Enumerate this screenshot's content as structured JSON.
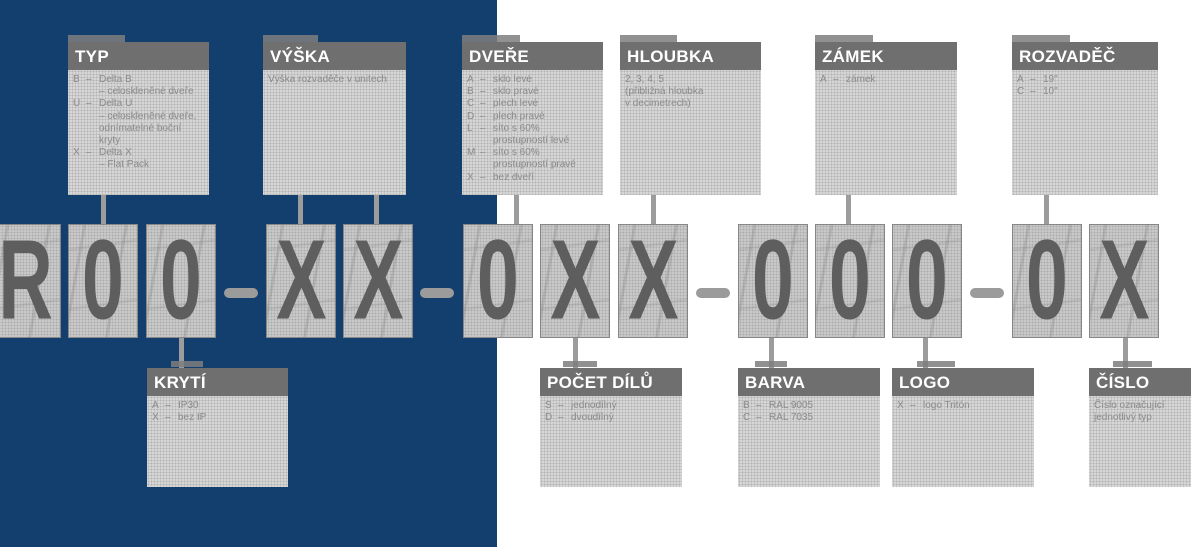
{
  "colors": {
    "panel_blue": "#123f6d",
    "header_gray": "#6f6f6f",
    "body_gray": "#d7d7d7",
    "char_box_gray": "#cfcfcf",
    "glyph_gray": "#5e5e5e",
    "connector_gray": "#9c9c9c",
    "body_text_gray": "#8b8b8b"
  },
  "code": {
    "chars": [
      "R",
      "0",
      "0",
      "X",
      "X",
      "0",
      "X",
      "X",
      "0",
      "0",
      "0",
      "0",
      "X"
    ],
    "separator": "–"
  },
  "top_labels": {
    "typ": {
      "title": "TYP",
      "lines": [
        {
          "k": "B",
          "t": "Delta B"
        },
        {
          "k": "",
          "t": "– celoskleněné dveře"
        },
        {
          "k": "U",
          "t": "Delta U"
        },
        {
          "k": "",
          "t": "– celoskleněné dveře,"
        },
        {
          "k": "",
          "t": "odnímatelné boční"
        },
        {
          "k": "",
          "t": "kryty"
        },
        {
          "k": "X",
          "t": "Delta X"
        },
        {
          "k": "",
          "t": "– Flat Pack"
        }
      ]
    },
    "vyska": {
      "title": "VÝŠKA",
      "lines": [
        {
          "p": "Výška rozvaděče v unitech"
        }
      ]
    },
    "dvere": {
      "title": "DVEŘE",
      "lines": [
        {
          "k": "A",
          "t": "sklo levé"
        },
        {
          "k": "B",
          "t": "sklo pravé"
        },
        {
          "k": "C",
          "t": "plech levé"
        },
        {
          "k": "D",
          "t": "plech pravé"
        },
        {
          "k": "L",
          "t": "síto s 60%"
        },
        {
          "k": "",
          "t": "prostupností levé"
        },
        {
          "k": "M",
          "t": "síto s 60%"
        },
        {
          "k": "",
          "t": "prostupností pravé"
        },
        {
          "k": "X",
          "t": "bez dveří"
        }
      ]
    },
    "hloubka": {
      "title": "HLOUBKA",
      "lines": [
        {
          "p": "2, 3, 4, 5"
        },
        {
          "p": "(přibližná hloubka"
        },
        {
          "p": "v decimetrech)"
        }
      ]
    },
    "zamek": {
      "title": "ZÁMEK",
      "lines": [
        {
          "k": "A",
          "t": "zámek"
        }
      ]
    },
    "rozvadec": {
      "title": "ROZVADĚČ",
      "lines": [
        {
          "k": "A",
          "t": "19\""
        },
        {
          "k": "C",
          "t": "10\""
        }
      ]
    }
  },
  "bottom_labels": {
    "kryti": {
      "title": "KRYTÍ",
      "lines": [
        {
          "k": "A",
          "t": "IP30"
        },
        {
          "k": "X",
          "t": "bez IP"
        }
      ]
    },
    "pocet_dilu": {
      "title": "POČET DÍLŮ",
      "lines": [
        {
          "k": "S",
          "t": "jednodílný"
        },
        {
          "k": "D",
          "t": "dvoudílný"
        }
      ]
    },
    "barva": {
      "title": "BARVA",
      "lines": [
        {
          "k": "B",
          "t": "RAL 9005"
        },
        {
          "k": "C",
          "t": "RAL 7035"
        }
      ]
    },
    "logo": {
      "title": "LOGO",
      "lines": [
        {
          "k": "X",
          "t": "logo Tritón"
        }
      ]
    },
    "cislo": {
      "title": "ČÍSLO",
      "lines": [
        {
          "p": "Číslo označující"
        },
        {
          "p": "jednotlivý typ"
        }
      ]
    }
  }
}
